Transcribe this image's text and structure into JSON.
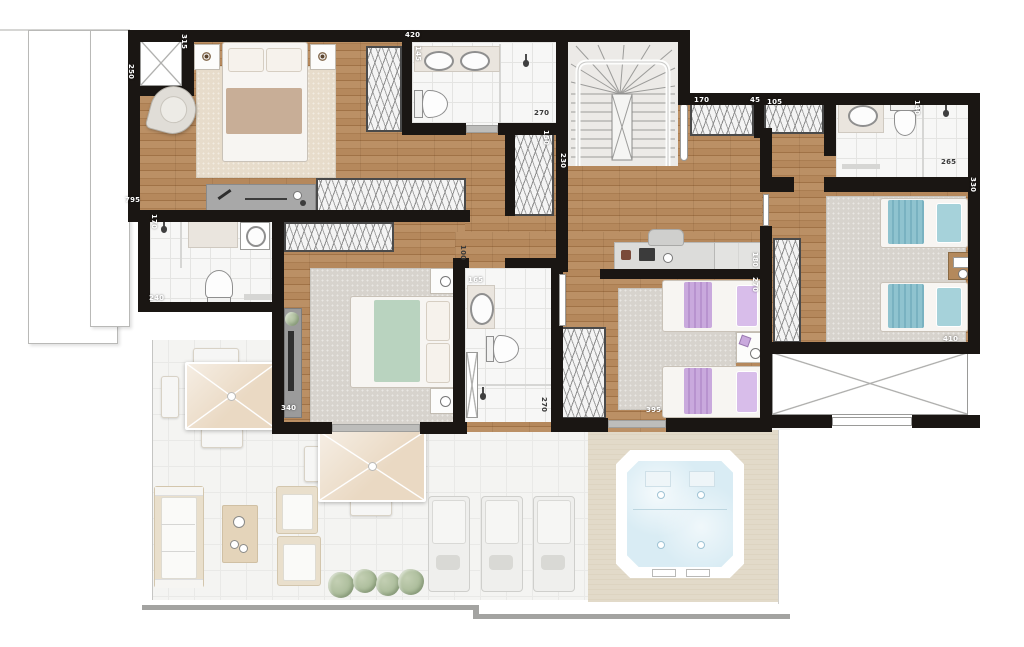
{
  "floorplan": {
    "dimension_labels": [
      "250",
      "315",
      "420",
      "145",
      "270",
      "150",
      "230",
      "170",
      "45",
      "105",
      "140",
      "265",
      "330",
      "410",
      "180",
      "270",
      "395",
      "100",
      "165",
      "270",
      "340",
      "240",
      "170",
      "795"
    ],
    "colors": {
      "wall": "#1a1613",
      "wood": "#b5885c",
      "tile": "#f7f7f6",
      "terrace_tile": "#f4f4f2",
      "deck": "#ddd4c1",
      "rug": "#d7d3cd",
      "rug_beige": "#e7dccb",
      "bed_teal": "#8fc3cf",
      "bed_lavender": "#c9a9dd",
      "bed_green": "#b9d3bf",
      "bed_taupe": "#c8ae97",
      "water": "#d9ecf4",
      "parasol": "#ead9c3",
      "plant": "#a7b996"
    }
  }
}
